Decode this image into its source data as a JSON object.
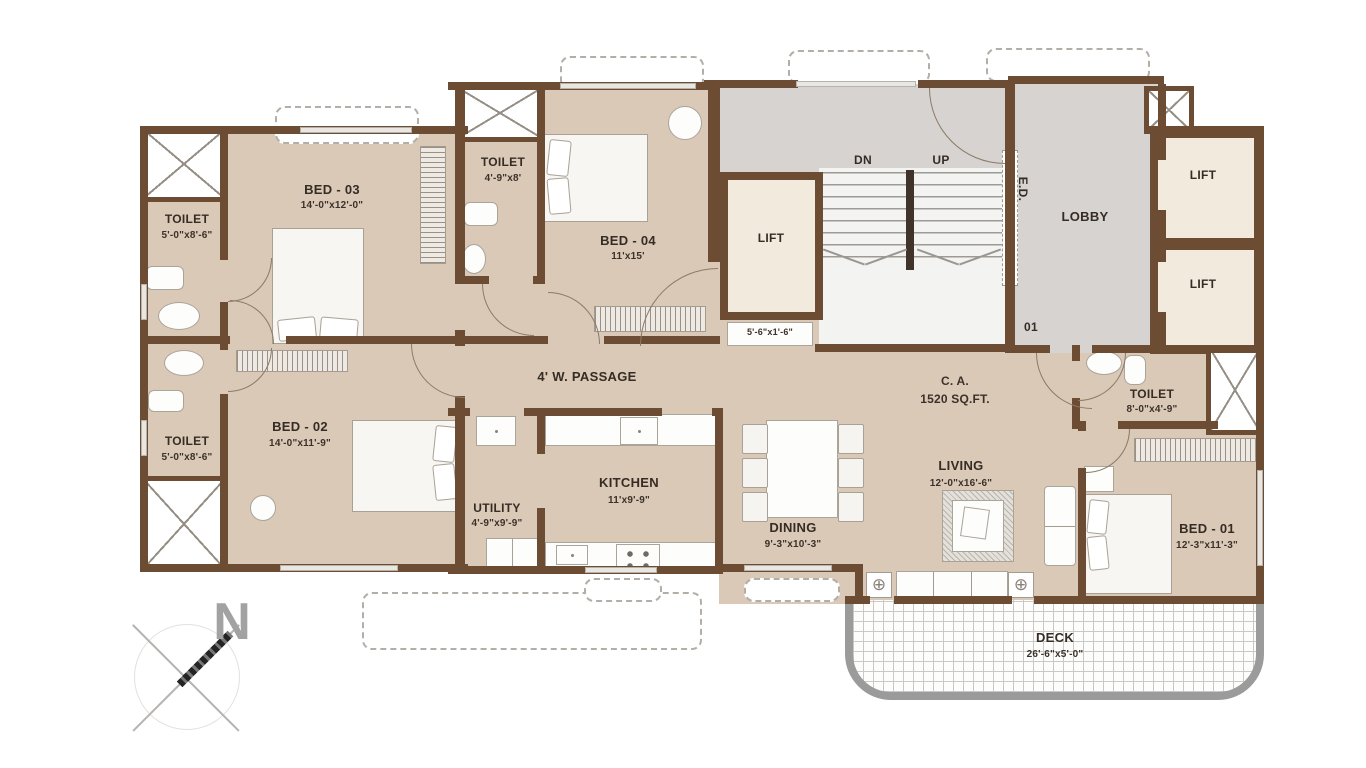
{
  "colors": {
    "wall": "#6d4c34",
    "floor": "#dbc9b8",
    "entry_gray": "#d6d3d0",
    "lift_cream": "#f2ebdd",
    "deck_border": "#9b9b9b",
    "text": "#352c24"
  },
  "icons": {
    "planter": "⊕",
    "compass_letter": "N"
  },
  "rooms": {
    "bed3": {
      "name": "BED - 03",
      "dims": "14'-0\"x12'-0\""
    },
    "bed4": {
      "name": "BED - 04",
      "dims": "11'x15'"
    },
    "bed2": {
      "name": "BED - 02",
      "dims": "14'-0\"x11'-9\""
    },
    "bed1": {
      "name": "BED - 01",
      "dims": "12'-3\"x11'-3\""
    },
    "toilet_top_left": {
      "name": "TOILET",
      "dims": "5'-0\"x8'-6\""
    },
    "toilet_mid": {
      "name": "TOILET",
      "dims": "4'-9\"x8'"
    },
    "toilet_bottom_left": {
      "name": "TOILET",
      "dims": "5'-0\"x8'-6\""
    },
    "toilet_right": {
      "name": "TOILET",
      "dims": "8'-0\"x4'-9\""
    },
    "kitchen": {
      "name": "KITCHEN",
      "dims": "11'x9'-9\""
    },
    "utility": {
      "name": "UTILITY",
      "dims": "4'-9\"x9'-9\""
    },
    "dining": {
      "name": "DINING",
      "dims": "9'-3\"x10'-3\""
    },
    "living": {
      "name": "LIVING",
      "dims": "12'-0\"x16'-6\""
    },
    "deck": {
      "name": "DECK",
      "dims": "26'-6\"x5'-0\""
    },
    "lobby": {
      "name": "LOBBY"
    },
    "lift": {
      "name": "LIFT"
    },
    "lift_shaft_dims": "5'-6\"x1'-6\"",
    "passage": {
      "name": "4' W. PASSAGE"
    },
    "stairs": {
      "down": "DN",
      "up": "UP"
    },
    "electrical_duct": "E.D.",
    "unit_number": "01",
    "carpet_area": {
      "line1": "C. A.",
      "line2": "1520 SQ.FT."
    }
  }
}
